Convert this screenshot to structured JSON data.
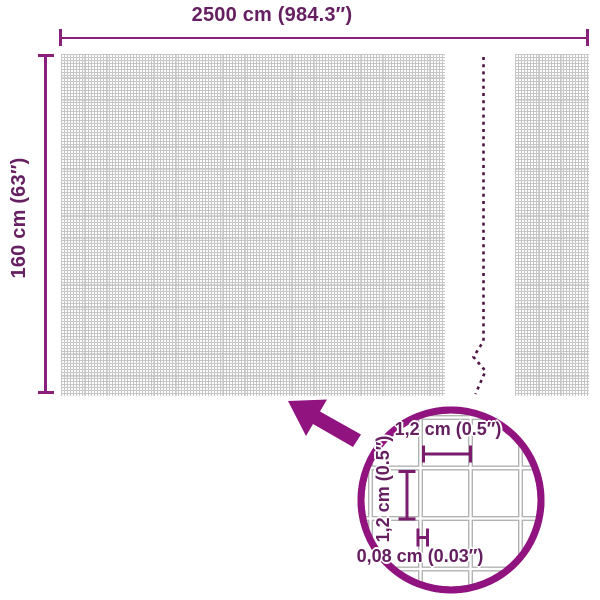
{
  "diagram": {
    "width_label": "2500 cm (984.3″)",
    "height_label": "160 cm (63″)",
    "detail_circle": {
      "cell_width_label": "1,2 cm (0.5″)",
      "cell_height_label": "1,2 cm (0.5″)",
      "wire_thickness_label": "0,08 cm (0.03″)"
    },
    "icons": {
      "zoom_arrow": "zoom-arrow-icon",
      "magnifier": "magnifier-circle",
      "break": "mesh-break-line"
    },
    "colors": {
      "accent_shape": "#90137F",
      "accent_line": "#8B1F7C",
      "accent_text": "#662061",
      "break_dash": "#4E1343",
      "mesh_grid": "#c6c6c6",
      "detail_grid": "#b2b2b2"
    }
  }
}
